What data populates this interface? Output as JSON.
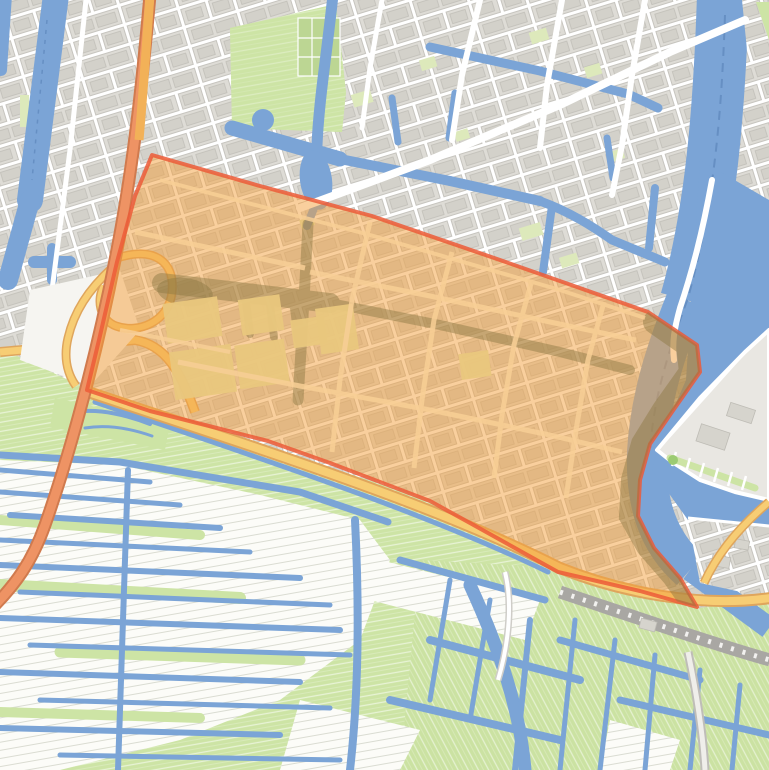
{
  "map": {
    "aria_label": "Street map with an orange highlighted district polygon, river on the right, urban grid above and polder fields with drainage ditches below",
    "type": "street-map",
    "overlay": {
      "name": "highlighted-district",
      "fill": "#F49F3C",
      "fill_opacity": 0.5,
      "stroke": "#EC5C38",
      "stroke_opacity": 0.85,
      "stroke_width": 4
    },
    "colors": {
      "water": "#7BA4D6",
      "urban_base": "#E8E6E1",
      "block": "#DEDCD6",
      "block_outline": "#C6C4BE",
      "road": "#FFFFFF",
      "green_field": "#CDE4A5",
      "white_field": "#FCFCF8",
      "motorway": "#EE9364",
      "motorway_casing": "#D07A4E",
      "motorway_north": "#F2B158",
      "secondary_road": "#F7CD74",
      "secondary_casing": "#DFA55C",
      "railway": "#A9A7A3",
      "overlay_water_tint": "#8F7A45",
      "overlay_building": "#E9C77D",
      "overlay_street": "#F8CF96",
      "nav_dash": "#5B84B8",
      "pale_green": "#DDE9BB"
    },
    "features": [
      "highlighted-district-overlay",
      "river",
      "city-canals",
      "urban-street-grid",
      "allotment-gardens",
      "polder-fields",
      "drainage-ditches",
      "motorway-interchange",
      "dike-road",
      "railway",
      "peninsula-marina"
    ]
  }
}
